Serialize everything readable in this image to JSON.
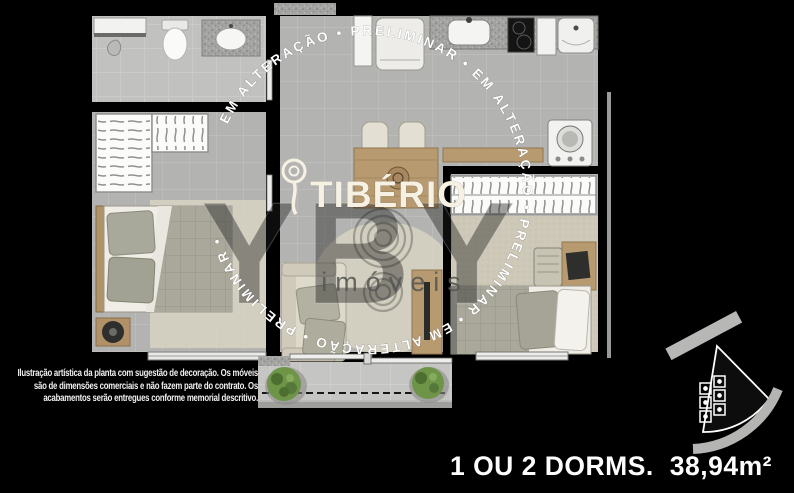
{
  "watermark": {
    "ring_text": "EM ALTERAÇÃO • PRELIMINAR • EM ALTERAÇÃO • PRELIMINAR • EM ALTERAÇÃO • PRELIMINAR • ",
    "brand": "TIBÉRIO",
    "agency": "YBY",
    "agency_sub": "imóveis"
  },
  "disclaimer": {
    "line1": "Ilustração artística da planta com sugestão de decoração. Os móveis",
    "line2": "são de dimensões comerciais e não fazem parte do contrato. Os",
    "line3": "acabamentos serão entregues conforme memorial descritivo."
  },
  "footer": {
    "dorms_label": "1 OU 2 DORMS.",
    "area_label": "38,94m²"
  },
  "colors": {
    "background": "#000000",
    "wall": "#000000",
    "floor_tile": "#b3b3b1",
    "bathroom_tile": "#c1c1bf",
    "terrace_tile": "#c5c5c3",
    "carpet_beige": "#cdc8b7",
    "rug_beige": "#d6d2c2",
    "wood": "#b79a6f",
    "fabric_gray": "#a9a89b",
    "granite": "#a3a3a1",
    "plant_green": "#6d9447",
    "appliance_white": "#f2f2f0",
    "watermark_white": "#ffffff",
    "logo_cream": "#f6f1e3",
    "text_white": "#f0f0f0"
  }
}
